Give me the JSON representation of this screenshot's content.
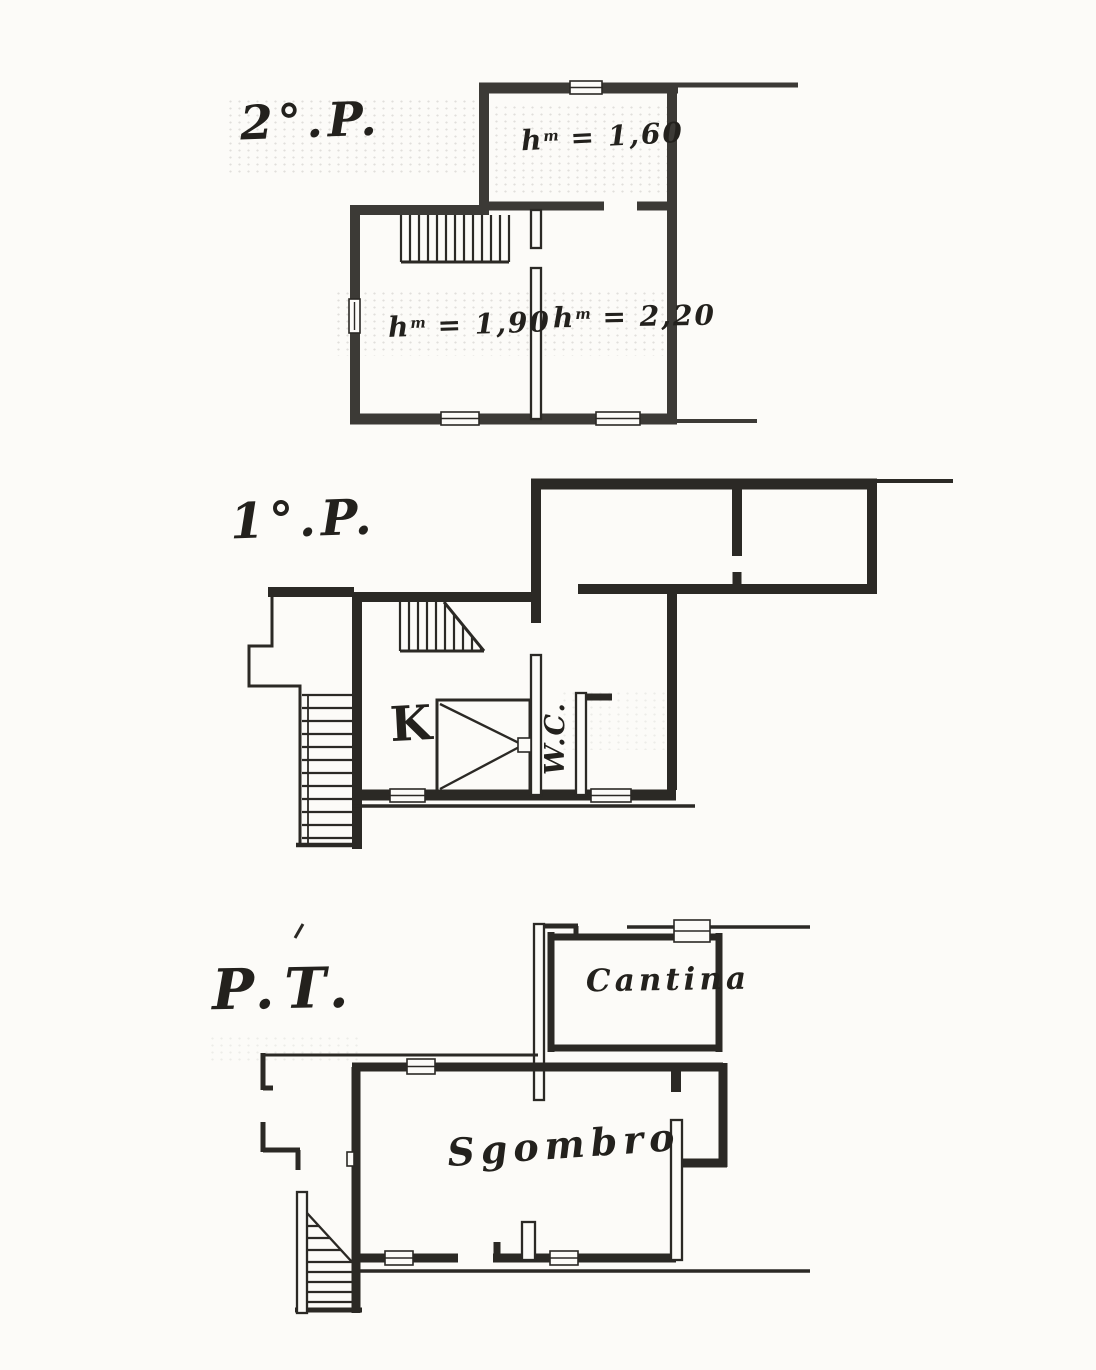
{
  "paper": {
    "background": "#fcfbf8",
    "ink": "#2b2925"
  },
  "floors": {
    "second": {
      "label": "2°.P.",
      "heights": {
        "attic_room": {
          "base": "h",
          "sup": "m",
          "value": " = 1,60"
        },
        "left_room": {
          "base": "h",
          "sup": "m",
          "value": " = 1,90"
        },
        "right_room": {
          "base": "h",
          "sup": "m",
          "value": " = 2,20"
        }
      }
    },
    "first": {
      "label": "1°.P.",
      "rooms": {
        "kitchen": "K",
        "wc": "W.C."
      }
    },
    "ground": {
      "label": "P.T.",
      "rooms": {
        "cellar": "Cantina",
        "storage": "Sgombro"
      }
    }
  }
}
